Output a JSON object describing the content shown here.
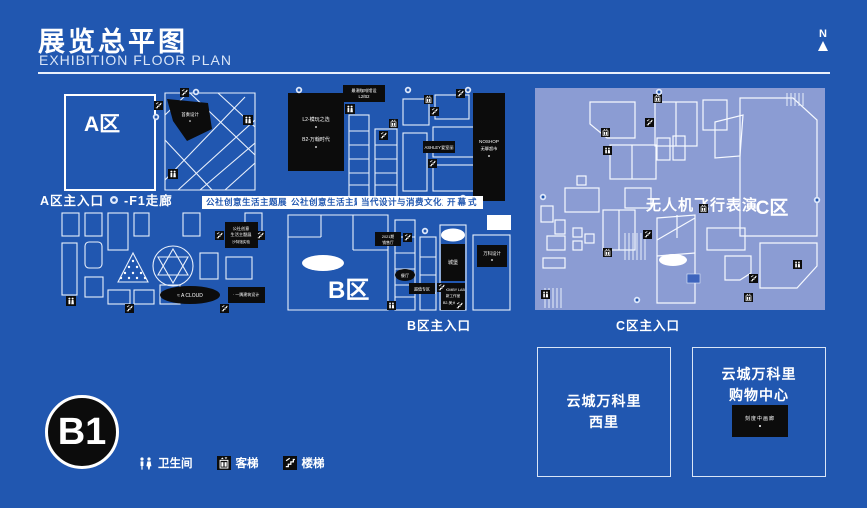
{
  "header": {
    "title_zh": "展览总平图",
    "title_en": "EXHIBITION FLOOR PLAN",
    "compass_n": "N"
  },
  "floor_badge": "B1",
  "legend": {
    "toilet": "卫生间",
    "elevator": "客梯",
    "stairs": "楼梯"
  },
  "zone_a": {
    "name": "A区",
    "entrance": "A区主入口",
    "corridor": "-F1走廊",
    "badge": "公社创意生活主题展",
    "studio_label": "首奏设计",
    "commune_box": {
      "line1": "公社创意",
      "line2": "生活主题展",
      "line3": "沙特馆实验"
    },
    "a_cloud": "≈ A CLOUD",
    "arch_label": "· 一隅建筑设计"
  },
  "zone_b": {
    "name": "B区",
    "entrance": "B区主入口",
    "badge1": "公社创意生活主题展",
    "badge2": "当代设计与消费文化主题展",
    "badge3": "开幕式",
    "cafe_label": {
      "line1": "最潮咖啡馆设",
      "line2": "L2/B2"
    },
    "store_box": {
      "line1": "L2-模玩之选",
      "line2": "B2-万翰时代"
    },
    "ashley": "ASHLEY爱室丽",
    "noshop": {
      "line1": "NOSHOP",
      "line2": "无聊超市"
    },
    "parking_oval": "白象车场",
    "sales_label": {
      "line1": "2021期",
      "line2": "销售厅"
    },
    "restaurant": "餐厅",
    "theater": "大剧场",
    "castle": "城堡",
    "lab": {
      "line1": "COOMBY LAB",
      "line2": "新工作室",
      "line3": "B2-美大创意"
    },
    "vanke_design": "万科设计",
    "deal_label": "超值专区"
  },
  "zone_c": {
    "name": "C区",
    "entrance": "C区主入口",
    "show": "无人机飞行表演",
    "hall": "星光厅"
  },
  "buildings": {
    "west": {
      "line1": "云城万科里",
      "line2": "西里"
    },
    "mall": {
      "line1": "云城万科里",
      "line2": "购物中心"
    },
    "mall_label": "刻度中画廊"
  },
  "colors": {
    "background": "#2157b0",
    "panel_c_bg": "#8b9cd3",
    "black": "#0c0c0c",
    "white": "#ffffff"
  }
}
